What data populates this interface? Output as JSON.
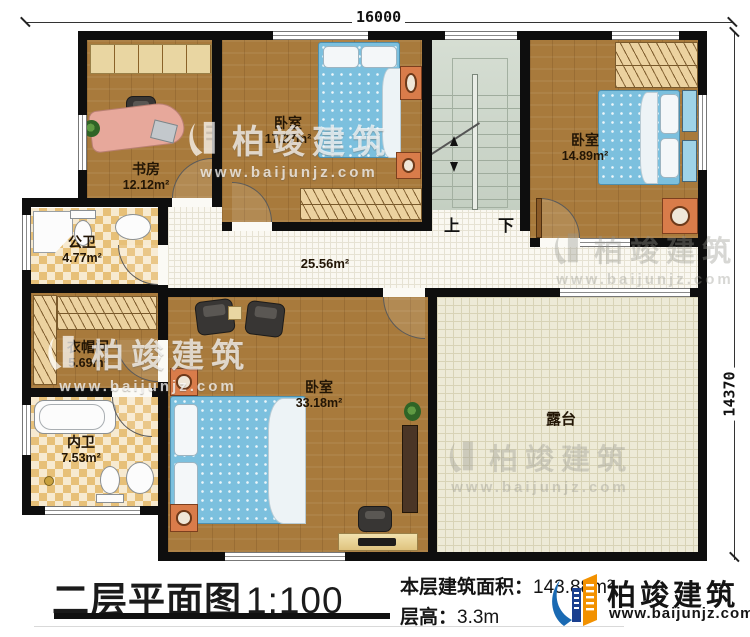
{
  "dimensions": {
    "top": "16000",
    "right": "14370"
  },
  "rooms": {
    "study": {
      "name": "书房",
      "area": "12.12m²"
    },
    "bedroom1": {
      "name": "卧室",
      "area": "17.27m²"
    },
    "bedroom2": {
      "name": "卧室",
      "area": "14.89m²"
    },
    "public_bath": {
      "name": "公卫",
      "area": "4.77m²"
    },
    "cloakroom": {
      "name": "衣帽间",
      "area": "5.69m²"
    },
    "ensuite_bath": {
      "name": "内卫",
      "area": "7.53m²"
    },
    "bedroom3": {
      "name": "卧室",
      "area": "33.18m²"
    },
    "terrace": {
      "name": "露台"
    },
    "hallway": {
      "area": "25.56m²"
    }
  },
  "stairs": {
    "up_label": "上",
    "down_label": "下"
  },
  "footer": {
    "plan_title": "二层平面图",
    "plan_scale": "1:100",
    "area_label": "本层建筑面积：",
    "area_value": "143.88m²",
    "height_label": "层高：",
    "height_value": "3.3m"
  },
  "brand": {
    "name": "柏竣建筑",
    "website": "www.baijunjz.com"
  },
  "watermark": {
    "name": "柏竣建筑",
    "website": "www.baijunjz.com"
  },
  "colors": {
    "wall": "#0e0e0e",
    "wood_floor": "#a87a3c",
    "bath_tile": "#e7c078",
    "terrace_tile": "#edead7",
    "bed": "#7cc0de",
    "brand_blue": "#1a6ab3",
    "brand_orange": "#f29100"
  }
}
